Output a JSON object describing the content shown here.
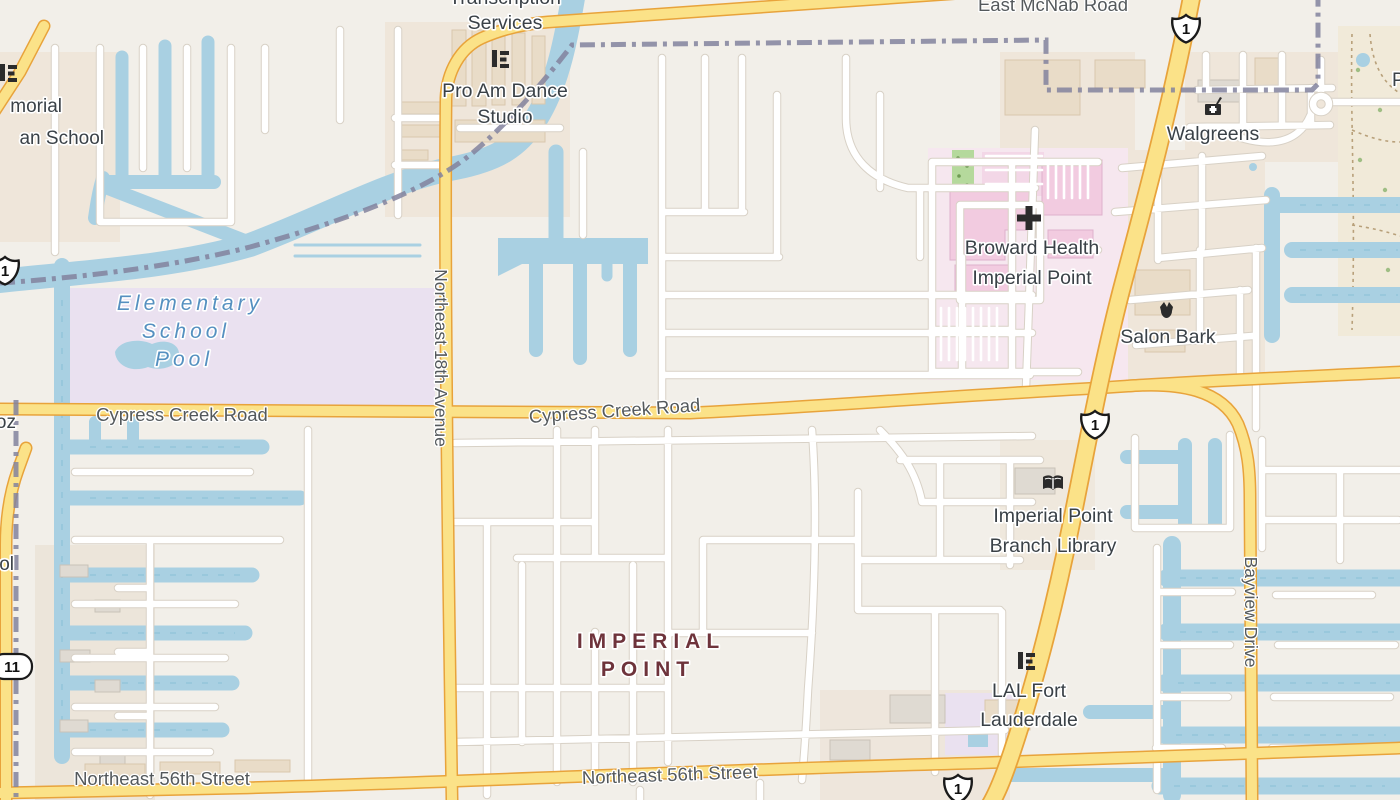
{
  "map_labels": {
    "pois": {
      "transcription_services_line1": "Transcription",
      "transcription_services_line2": "Services",
      "pro_am_line1": "Pro Am Dance",
      "pro_am_line2": "Studio",
      "walgreens": "Walgreens",
      "broward_health_line1": "Broward Health",
      "broward_health_line2": "Imperial Point",
      "salon_bark": "Salon Bark",
      "library_line1": "Imperial Point",
      "library_line2": "Branch Library",
      "lal_line1": "LAL Fort",
      "lal_line2": "Lauderdale",
      "memorial_school_line1": "morial",
      "memorial_school_line2": "an School",
      "partial_oz": "oz",
      "partial_ol": "ol",
      "partial_p": "P"
    },
    "roads": {
      "east_mcnab": "East McNab Road",
      "cypress_creek_west": "Cypress Creek Road",
      "cypress_creek_center": "Cypress Creek Road",
      "ne_18th_ave": "Northeast 18th Avenue",
      "ne_56th_west": "Northeast 56th Street",
      "ne_56th_center": "Northeast 56th Street",
      "bayview_drive": "Bayview Drive"
    },
    "water": {
      "school_pool_line1": "Elementary",
      "school_pool_line2": "School",
      "school_pool_line3": "Pool"
    },
    "neighborhood": {
      "line1": "IMPERIAL",
      "line2": "POINT"
    },
    "shields": {
      "us1": "1",
      "sr811": "11"
    },
    "icons": {
      "storefront": "storefront-icon",
      "pharmacy": "pharmacy-icon",
      "hospital": "hospital-cross-icon",
      "library": "book-icon",
      "pet_salon": "dog-icon"
    },
    "colors": {
      "land": "#f2efe9",
      "water": "#a9d0e2",
      "secondary_road_fill": "#fbe288",
      "secondary_road_casing": "#e8a33b",
      "minor_road_fill": "#ffffff",
      "minor_road_casing": "#d8d1c6",
      "boundary": "#82829e",
      "school_area": "#eae1f0",
      "hospital_area": "#f6e7ef",
      "commercial_area": "#efe6da",
      "park_green": "#b5d99c",
      "poi_text": "#3a4147",
      "road_text": "#54595c",
      "water_text": "#5590c0",
      "neighborhood_text": "#6e333b"
    }
  }
}
